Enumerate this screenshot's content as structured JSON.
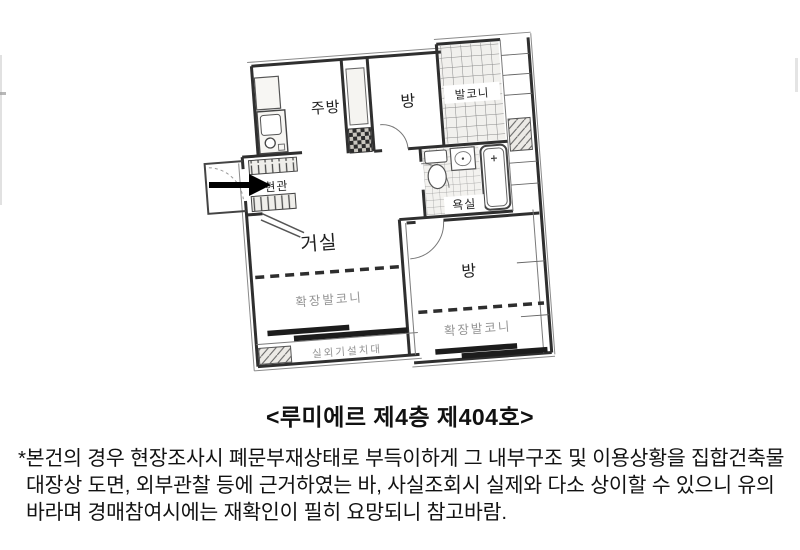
{
  "title": "<루미에르 제4층 제404호>",
  "floor_plan": {
    "labels": {
      "kitchen": "주방",
      "room_top": "방",
      "balcony": "발코니",
      "entrance": "현관",
      "bathroom": "욕실",
      "living_room": "거실",
      "room_right": "방",
      "extended_balcony_left": "확장발코니",
      "extended_balcony_right": "확장발코니",
      "outdoor_unit_stand": "실외기설치대"
    },
    "colors": {
      "wall_line": "#2f2f2f",
      "thin_line": "#7a7a7a",
      "minor_label": "#949494",
      "room_label": "#1f1f1f",
      "arrow": "#000000"
    }
  },
  "note": {
    "lines": [
      "*본건의 경우 현장조사시 폐문부재상태로 부득이하게 그 내부구조 및 이용상황을 집합건축물",
      "대장상 도면, 외부관찰 등에 근거하였는 바, 사실조회시 실제와 다소 상이할 수 있으니 유의",
      "바라며 경매참여시에는 재확인이 필히 요망되니 참고바람."
    ]
  }
}
